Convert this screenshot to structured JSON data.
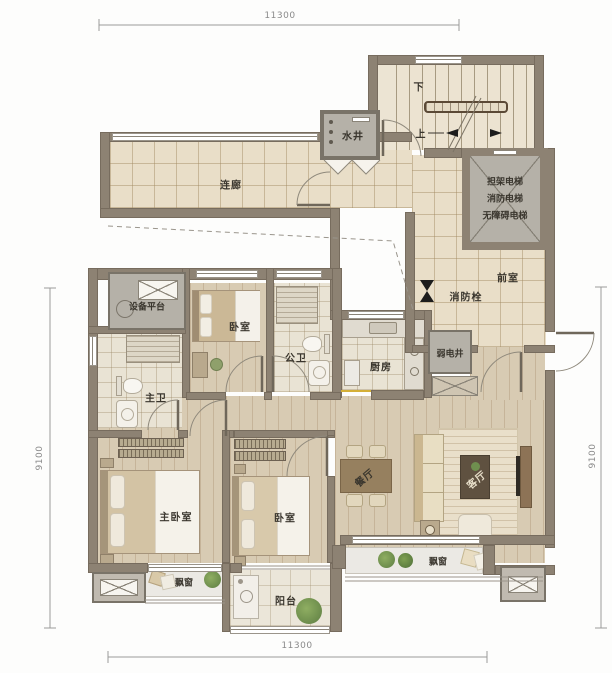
{
  "labels": {
    "corridor": "连廊",
    "water_shaft": "水井",
    "stair_down": "下",
    "stair_up": "上",
    "elevator_line1": "担架电梯",
    "elevator_line2": "消防电梯",
    "elevator_line3": "无障碍电梯",
    "anteroom": "前室",
    "fire_hydrant": "消防栓",
    "weak_current_shaft": "弱电井",
    "equipment_platform": "设备平台",
    "bedroom_top": "卧室",
    "guest_bath": "公卫",
    "kitchen": "厨房",
    "master_bath": "主卫",
    "master_bedroom": "主卧室",
    "bedroom_bottom": "卧室",
    "dining": "餐厅",
    "living": "客厅",
    "bay_window_left": "飘窗",
    "bay_window_right": "飘窗",
    "balcony": "阳台"
  },
  "dimensions": {
    "top": "11300",
    "bottom": "11300",
    "left": "9100",
    "right": "9100"
  },
  "colors": {
    "wall": "#8d8273",
    "corridor_tile": "#e9dec8",
    "wood_floor": "#d8cbb3",
    "shaft_gray": "#b5b1a8",
    "threshold_gold": "#d4af37",
    "hydrant_black": "#1c1c1c"
  }
}
